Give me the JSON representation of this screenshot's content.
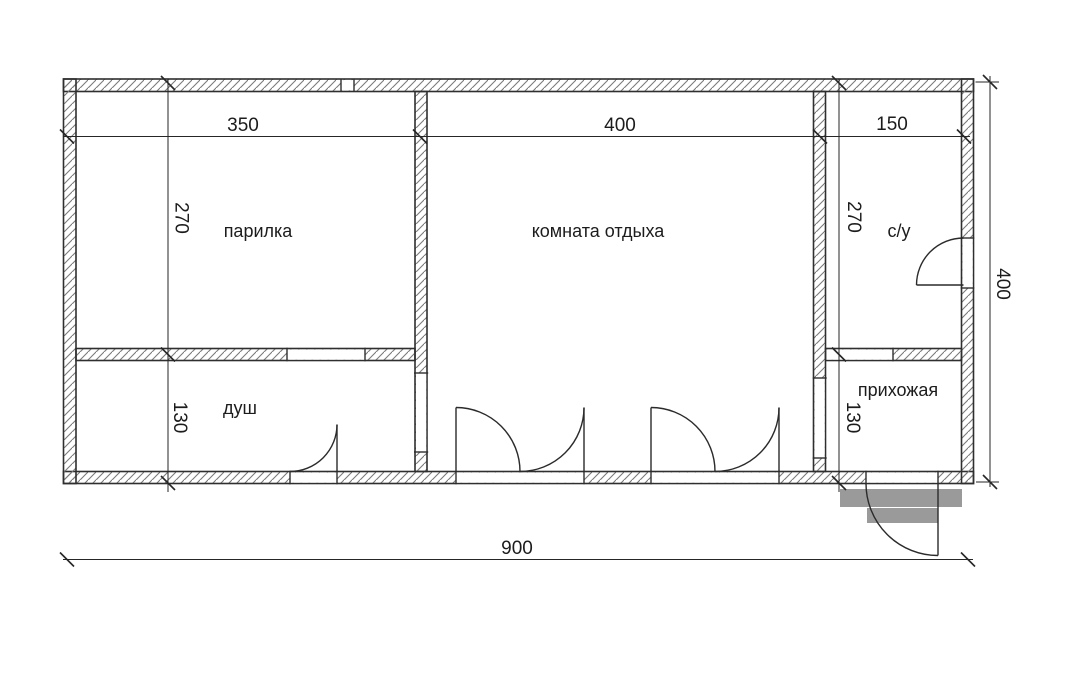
{
  "plan_title": "sauna floor plan",
  "rooms": [
    {
      "name": "парилка"
    },
    {
      "name": "комната отдыха"
    },
    {
      "name": "с/у"
    },
    {
      "name": "душ"
    },
    {
      "name": "прихожая"
    }
  ],
  "dimensions": {
    "top": [
      "350",
      "400",
      "150"
    ],
    "left_vertical": [
      "270",
      "130"
    ],
    "inner_right_vertical": [
      "270",
      "130"
    ],
    "right_overall": "400",
    "bottom_overall": "900"
  },
  "colors": {
    "background": "#ffffff",
    "wall_line": "#2f2f2f",
    "hatch": "#7a7a7a",
    "dimension_line": "#262626",
    "text": "#1c1c1c",
    "steps_fill": "#9a9a9a"
  }
}
